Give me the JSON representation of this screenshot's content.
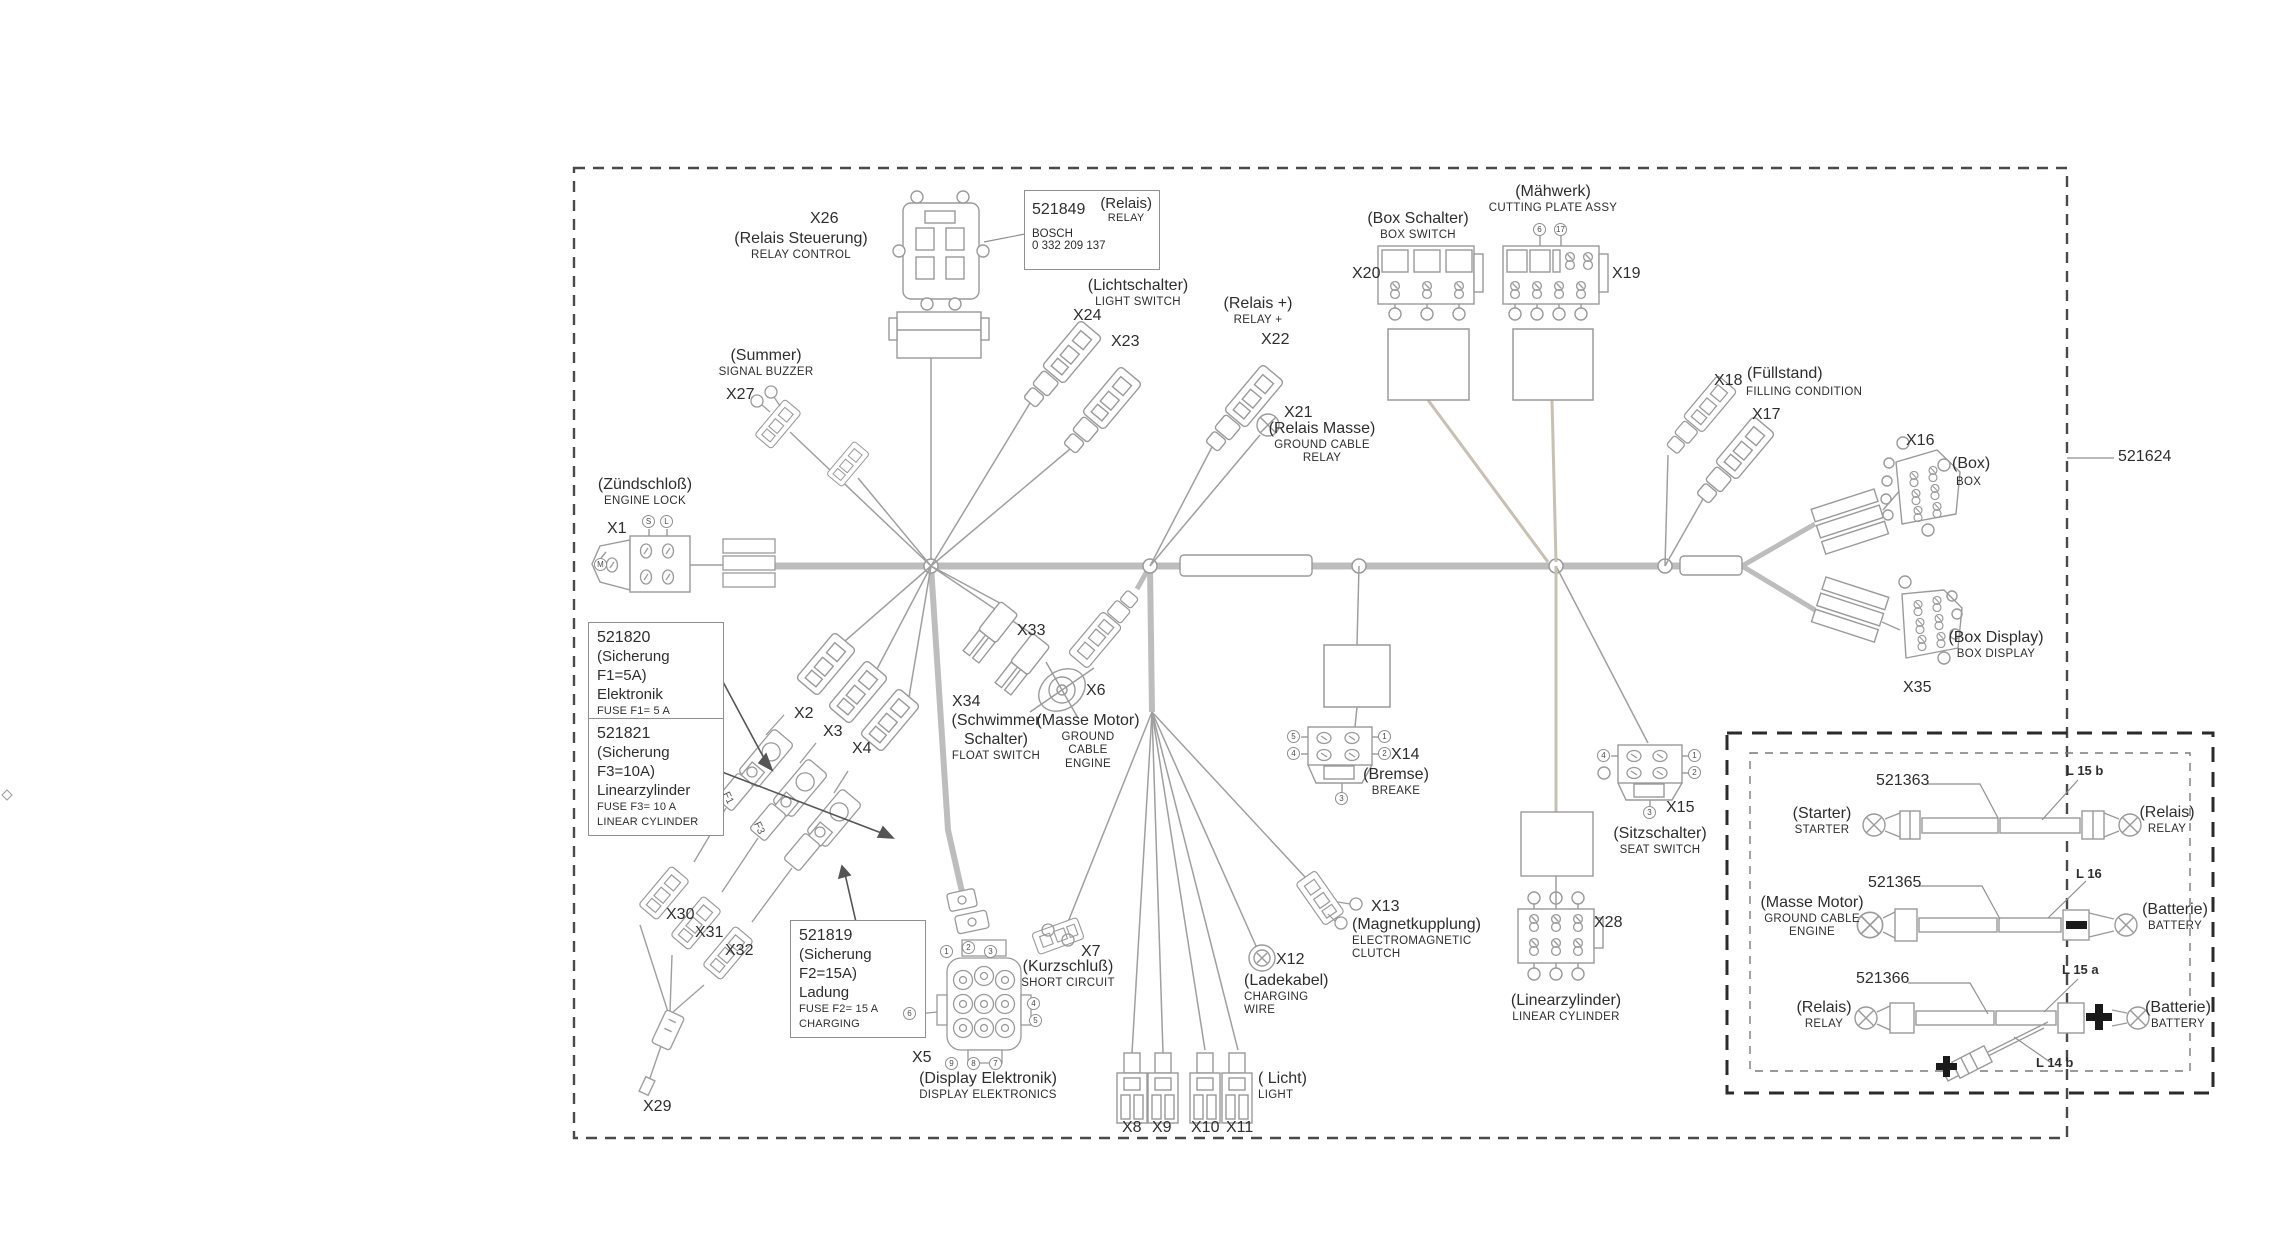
{
  "part_callout": {
    "number": "521624"
  },
  "boxes": {
    "relay": {
      "number": "521849",
      "de": "(Relais)",
      "en": "RELAY",
      "brand": "BOSCH",
      "brand_no": "0 332 209 137"
    },
    "fuse1": {
      "number": "521820",
      "de": "(Sicherung F1=5A)",
      "name": "Elektronik",
      "en1": "FUSE F1= 5 A",
      "en2": "ELEKTRONICS"
    },
    "fuse3": {
      "number": "521821",
      "de": "(Sicherung F3=10A)",
      "name": "Linearzylinder",
      "en1": "FUSE F3= 10 A",
      "en2": "LINEAR CYLINDER"
    },
    "fuse2": {
      "number": "521819",
      "de": "(Sicherung F2=15A)",
      "name": "Ladung",
      "en1": "FUSE F2= 15 A",
      "en2": "CHARGING"
    }
  },
  "connectors": {
    "x26": {
      "id": "X26",
      "de": "(Relais Steuerung)",
      "en": "RELAY CONTROL"
    },
    "light_switch": {
      "de": "(Lichtschalter)",
      "en": "LIGHT SWITCH"
    },
    "x24": {
      "id": "X24"
    },
    "x23": {
      "id": "X23"
    },
    "x22": {
      "id": "X22",
      "de": "(Relais +)",
      "en": "RELAY +"
    },
    "x21": {
      "id": "X21",
      "de": "(Relais Masse)",
      "en1": "GROUND CABLE",
      "en2": "RELAY"
    },
    "x20": {
      "id": "X20",
      "de": "(Box Schalter)",
      "en": "BOX SWITCH"
    },
    "x19": {
      "id": "X19",
      "de": "(Mähwerk)",
      "en": "CUTTING PLATE ASSY"
    },
    "x18": {
      "id": "X18",
      "de": "(Füllstand)",
      "en": "FILLING CONDITION"
    },
    "x17": {
      "id": "X17"
    },
    "x16": {
      "id": "X16",
      "de": "(Box)",
      "en": "BOX"
    },
    "x35": {
      "id": "X35",
      "de": "(Box Display)",
      "en": "BOX DISPLAY"
    },
    "x27": {
      "id": "X27",
      "de": "(Summer)",
      "en": "SIGNAL BUZZER"
    },
    "x1": {
      "id": "X1",
      "de": "(Zündschloß)",
      "en": "ENGINE LOCK"
    },
    "x2": {
      "id": "X2"
    },
    "x3": {
      "id": "X3"
    },
    "x4": {
      "id": "X4"
    },
    "x33": {
      "id": "X33"
    },
    "x34": {
      "id": "X34",
      "de1": "(Schwimmer",
      "de2": "Schalter)",
      "en": "FLOAT SWITCH"
    },
    "x6": {
      "id": "X6",
      "de": "(Masse Motor)",
      "en1": "GROUND",
      "en2": "CABLE",
      "en3": "ENGINE"
    },
    "x14": {
      "id": "X14",
      "de": "(Bremse)",
      "en": "BREAKE"
    },
    "x15": {
      "id": "X15",
      "de": "(Sitzschalter)",
      "en": "SEAT SWITCH"
    },
    "x13": {
      "id": "X13",
      "de": "(Magnetkupplung)",
      "en1": "ELECTROMAGNETIC",
      "en2": "CLUTCH"
    },
    "x12": {
      "id": "X12",
      "de": "(Ladekabel)",
      "en1": "CHARGING",
      "en2": "WIRE"
    },
    "x28": {
      "id": "X28",
      "de": "(Linearzylinder)",
      "en": "LINEAR CYLINDER"
    },
    "x7": {
      "id": "X7",
      "de": "(Kurzschluß)",
      "en": "SHORT CIRCUIT"
    },
    "x5": {
      "id": "X5",
      "de": "(Display Elektronik)",
      "en": "DISPLAY ELEKTRONICS"
    },
    "x8": {
      "id": "X8"
    },
    "x9": {
      "id": "X9"
    },
    "x10": {
      "id": "X10"
    },
    "x11": {
      "id": "X11"
    },
    "licht": {
      "de": "( Licht)",
      "en": "LIGHT"
    },
    "x30": {
      "id": "X30"
    },
    "x31": {
      "id": "X31"
    },
    "x32": {
      "id": "X32"
    },
    "x29": {
      "id": "X29"
    }
  },
  "pins": {
    "x1": [
      "S",
      "L",
      "M"
    ],
    "x14": [
      "5",
      "4",
      "1",
      "2",
      "3"
    ],
    "x15": [
      "4",
      "1",
      "2",
      "3"
    ],
    "x19": [
      "6",
      "17"
    ],
    "x5_top": [
      "1",
      "2",
      "3"
    ],
    "x5_left": [
      "6"
    ],
    "x5_right": [
      "4",
      "5"
    ],
    "x5_bottom": [
      "9",
      "8",
      "7"
    ]
  },
  "fuse_tags": {
    "f1": "F1",
    "f3": "F3"
  },
  "inset": {
    "cables": [
      {
        "number": "521363",
        "length_label": "L 15 b",
        "left_de": "(Starter)",
        "left_en": "STARTER",
        "right_de": "(Relais)",
        "right_en": "RELAY"
      },
      {
        "number": "521365",
        "length_label": "L 16",
        "left_de": "(Masse Motor)",
        "left_en1": "GROUND CABLE",
        "left_en2": "ENGINE",
        "right_de": "(Batterie)",
        "right_en": "BATTERY"
      },
      {
        "number": "521366",
        "length_label": "L 15 a",
        "branch_label": "L 14 b",
        "left_de": "(Relais)",
        "left_en": "RELAY",
        "right_de": "(Batterie)",
        "right_en": "BATTERY"
      }
    ]
  }
}
